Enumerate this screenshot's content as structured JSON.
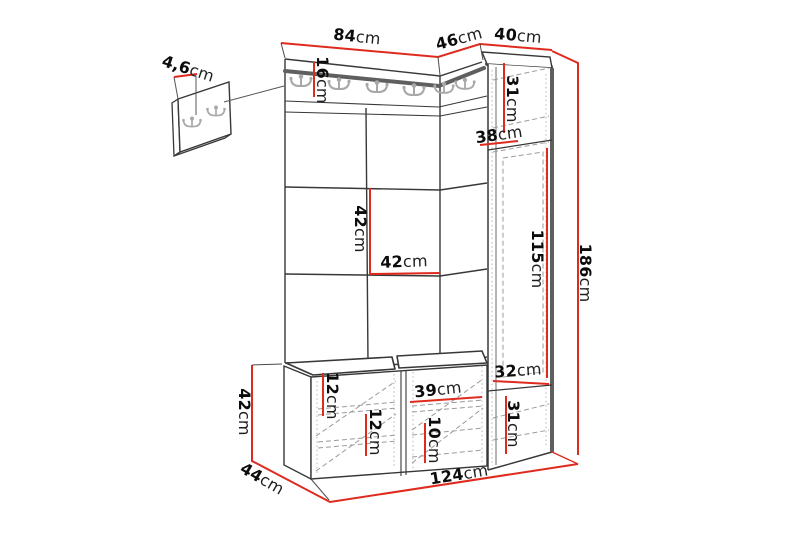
{
  "diagram": {
    "kind": "furniture-dimension-diagram",
    "unit": "cm",
    "colors": {
      "dimension_line": "#df2a1e",
      "outline": "#2f2f2f",
      "thick_edge": "#5f5f5f",
      "hidden_line": "#9b9b9b",
      "hook": "#a8a8a8"
    },
    "icons": {
      "coat_hook": "double-prong-wall-hook"
    },
    "dims": {
      "panel_depth": {
        "value": "4,6",
        "unit": "cm"
      },
      "top_main": {
        "value": "84",
        "unit": "cm"
      },
      "top_corner": {
        "value": "46",
        "unit": "cm"
      },
      "top_cabinet": {
        "value": "40",
        "unit": "cm"
      },
      "rail_height": {
        "value": "16",
        "unit": "cm"
      },
      "cab_top_shelf": {
        "value": "31",
        "unit": "cm"
      },
      "cab_depth": {
        "value": "38",
        "unit": "cm"
      },
      "tile_height": {
        "value": "42",
        "unit": "cm"
      },
      "tile_width": {
        "value": "42",
        "unit": "cm"
      },
      "cab_middle": {
        "value": "115",
        "unit": "cm"
      },
      "total_height": {
        "value": "186",
        "unit": "cm"
      },
      "cab_gap": {
        "value": "32",
        "unit": "cm"
      },
      "cab_bottom": {
        "value": "31",
        "unit": "cm"
      },
      "bench_frame": {
        "value": "12",
        "unit": "cm"
      },
      "bench_shelf": {
        "value": "12",
        "unit": "cm"
      },
      "bench_mid_w": {
        "value": "39",
        "unit": "cm"
      },
      "bench_bottom": {
        "value": "10",
        "unit": "cm"
      },
      "bench_height": {
        "value": "42",
        "unit": "cm"
      },
      "bench_depth": {
        "value": "44",
        "unit": "cm"
      },
      "total_width": {
        "value": "124",
        "unit": "cm"
      }
    }
  }
}
